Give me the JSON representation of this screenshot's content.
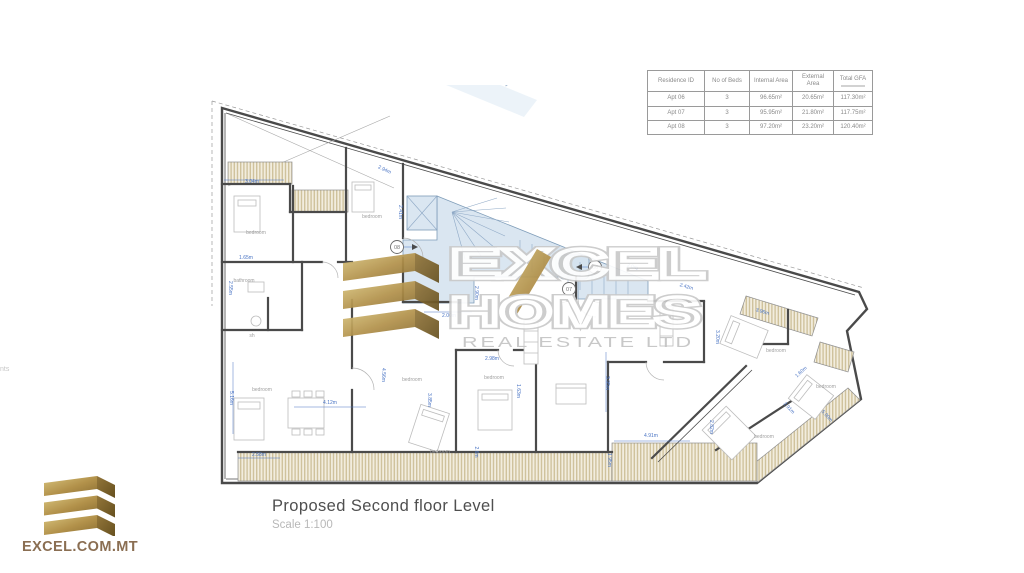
{
  "table": {
    "headers": [
      "Residence ID",
      "No of Beds",
      "Internal Area",
      "External Area",
      "Total GFA"
    ],
    "rows": [
      [
        "Apt 06",
        "3",
        "96.65m²",
        "20.65m²",
        "117.30m²"
      ],
      [
        "Apt 07",
        "3",
        "95.95m²",
        "21.80m²",
        "117.75m²"
      ],
      [
        "Apt 08",
        "3",
        "97.20m²",
        "23.20m²",
        "120.40m²"
      ]
    ]
  },
  "watermark": {
    "line1": "EXCEL",
    "line2": "HOMES",
    "line3": "REAL ESTATE LTD"
  },
  "title_block": {
    "title": "Proposed Second floor Level",
    "scale": "Scale 1:100"
  },
  "footer_logo": {
    "text": "EXCEL.COM.MT"
  },
  "edge_fragment": "nts",
  "colors": {
    "gold_light": "#d5bd74",
    "gold_dark": "#a4843e",
    "fold_dark": "#6e5524",
    "dimension_blue": "#4a74c4",
    "wall_gray": "#4a4a4a",
    "stair_blue": "#d3e2ef",
    "balcony_tan": "#cfc29c"
  },
  "plan": {
    "room_labels": [
      {
        "t": "bedroom",
        "x": 256,
        "y": 234
      },
      {
        "t": "bedroom",
        "x": 372,
        "y": 218
      },
      {
        "t": "bathroom",
        "x": 244,
        "y": 282
      },
      {
        "t": "sh",
        "x": 252,
        "y": 337
      },
      {
        "t": "bedroom",
        "x": 262,
        "y": 391
      },
      {
        "t": "bedroom",
        "x": 412,
        "y": 381
      },
      {
        "t": "bedroom",
        "x": 494,
        "y": 379
      },
      {
        "t": "bedroom",
        "x": 440,
        "y": 453
      },
      {
        "t": "bedroom",
        "x": 776,
        "y": 352
      },
      {
        "t": "bedroom",
        "x": 826,
        "y": 388
      },
      {
        "t": "bedroom",
        "x": 764,
        "y": 438
      }
    ],
    "dimensions": [
      {
        "t": "3.04m",
        "x": 252,
        "y": 183,
        "r": 0
      },
      {
        "t": "2.94m",
        "x": 384,
        "y": 171,
        "r": 25
      },
      {
        "t": "2.41m",
        "x": 399,
        "y": 212,
        "r": 90
      },
      {
        "t": "1.65m",
        "x": 246,
        "y": 259,
        "r": 0
      },
      {
        "t": "2.55m",
        "x": 229,
        "y": 288,
        "r": 90
      },
      {
        "t": "5.16m",
        "x": 230,
        "y": 398,
        "r": 90
      },
      {
        "t": "2.58m",
        "x": 259,
        "y": 456,
        "r": 0
      },
      {
        "t": "4.12m",
        "x": 330,
        "y": 404,
        "r": 0
      },
      {
        "t": "4.56m",
        "x": 382,
        "y": 375,
        "r": 90
      },
      {
        "t": "3.85m",
        "x": 428,
        "y": 400,
        "r": 90
      },
      {
        "t": "2.98m",
        "x": 492,
        "y": 360,
        "r": 0
      },
      {
        "t": "1.63m",
        "x": 517,
        "y": 391,
        "r": 90
      },
      {
        "t": "2.6m",
        "x": 475,
        "y": 452,
        "r": 90
      },
      {
        "t": "2.00m",
        "x": 449,
        "y": 317,
        "r": 0
      },
      {
        "t": "2.90m",
        "x": 475,
        "y": 293,
        "r": 90
      },
      {
        "t": "3.95m",
        "x": 606,
        "y": 383,
        "r": 90
      },
      {
        "t": "1.95m",
        "x": 608,
        "y": 460,
        "r": 90
      },
      {
        "t": "4.91m",
        "x": 651,
        "y": 437,
        "r": 0
      },
      {
        "t": "2.82m",
        "x": 710,
        "y": 427,
        "r": 90
      },
      {
        "t": "2.91m",
        "x": 788,
        "y": 409,
        "r": 47
      },
      {
        "t": "5.00m",
        "x": 826,
        "y": 417,
        "r": 47
      },
      {
        "t": "1.60m",
        "x": 802,
        "y": 373,
        "r": -42
      },
      {
        "t": "3.96m",
        "x": 762,
        "y": 313,
        "r": 17
      },
      {
        "t": "3.20m",
        "x": 716,
        "y": 337,
        "r": 90
      },
      {
        "t": "2.42m",
        "x": 686,
        "y": 288,
        "r": 17
      },
      {
        "t": "2.0m",
        "x": 632,
        "y": 268,
        "r": 17
      }
    ],
    "markers": [
      {
        "t": "08",
        "x": 397,
        "y": 247
      },
      {
        "t": "06",
        "x": 595,
        "y": 267
      },
      {
        "t": "07",
        "x": 569,
        "y": 289
      }
    ]
  }
}
